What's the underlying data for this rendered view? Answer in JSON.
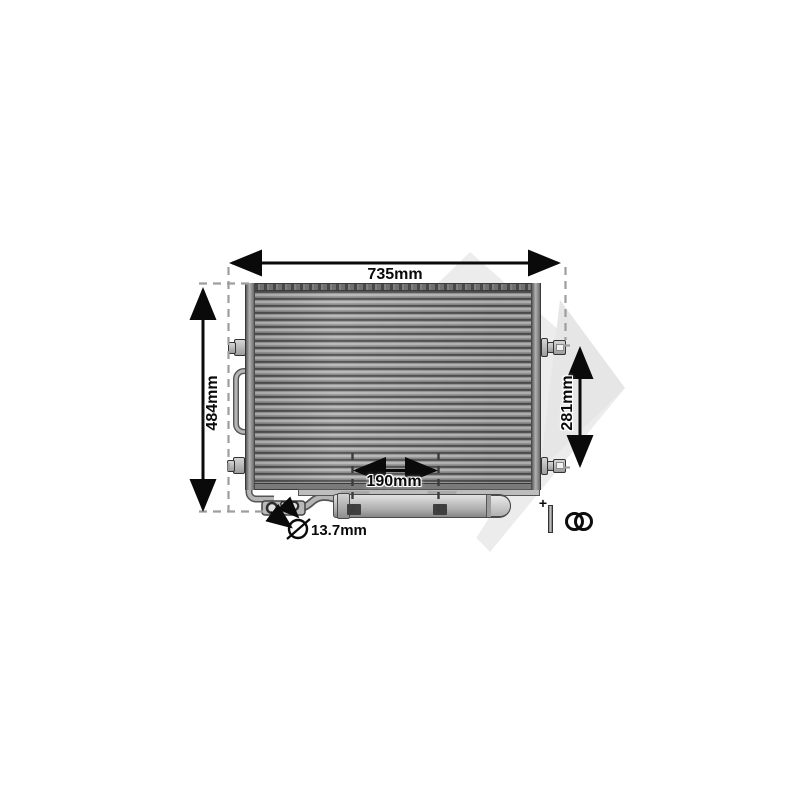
{
  "image": {
    "title": "Air conditioning condenser technical drawing",
    "part": "condenser with receiver drier and fitting kit"
  },
  "dimensions": {
    "overall_width": {
      "label": "735mm",
      "value": 735,
      "unit": "mm"
    },
    "overall_height": {
      "label": "484mm",
      "value": 484,
      "unit": "mm"
    },
    "core_height": {
      "label": "281mm",
      "value": 281,
      "unit": "mm"
    },
    "drier_span": {
      "label": "190mm",
      "value": 190,
      "unit": "mm"
    },
    "port_diameter": {
      "label": "13.7mm",
      "value": 13.7,
      "unit": "mm",
      "symbol": "diameter"
    }
  },
  "accessories": {
    "plus_sign": "+",
    "items": [
      "mounting-pin",
      "o-ring",
      "o-ring"
    ]
  },
  "colors": {
    "background": "#ffffff",
    "dimension_ink": "#0a0a0a",
    "extension_dash": "#9e9e9e",
    "watermark": "#ececec",
    "metal_light": "#c6c6c6",
    "metal_dark": "#4e4e4e"
  }
}
